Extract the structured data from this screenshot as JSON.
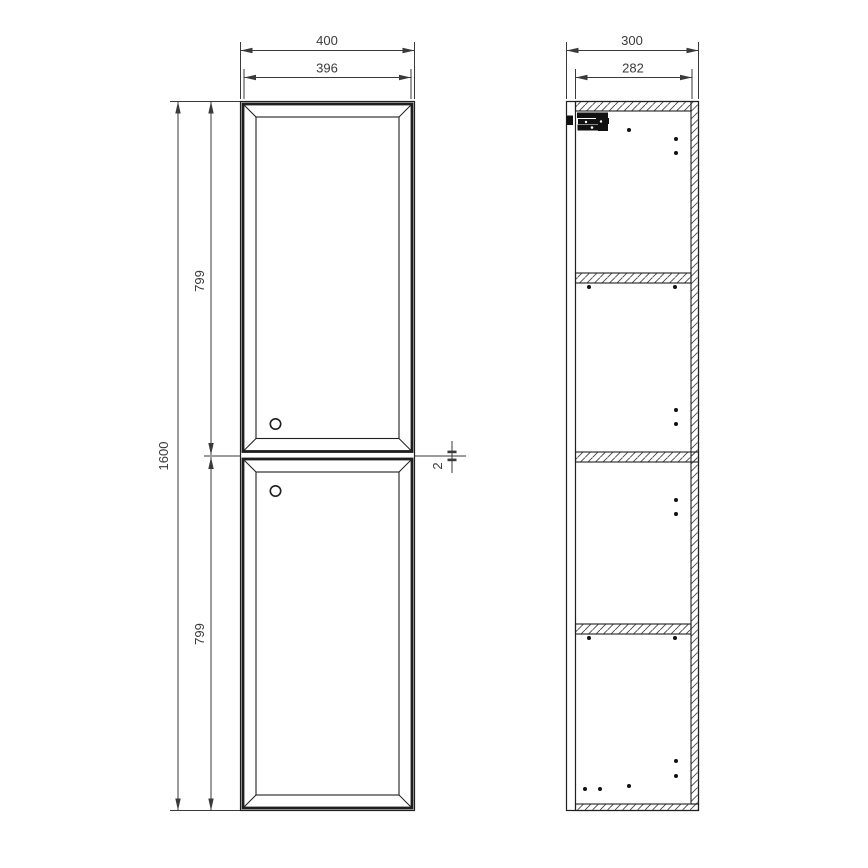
{
  "colors": {
    "background": "#ffffff",
    "object_line": "#1f1f1f",
    "dimension_line": "#3a3a3a",
    "hatch_line": "#444444",
    "hinge_fill": "#111111"
  },
  "front_view": {
    "dims": {
      "width_outer": "400",
      "width_inner": "396",
      "height_total": "1600",
      "upper_door_height": "799",
      "lower_door_height": "799",
      "door_gap": "2"
    },
    "knobs": [
      [
        275.5,
        424
      ],
      [
        275.5,
        491
      ]
    ]
  },
  "side_view": {
    "dims": {
      "depth_outer": "300",
      "depth_inner": "282"
    },
    "drill_holes": [
      [
        629,
        130
      ],
      [
        676,
        139
      ],
      [
        676,
        153
      ],
      [
        589,
        287
      ],
      [
        675,
        287
      ],
      [
        676,
        410
      ],
      [
        676,
        424
      ],
      [
        676,
        500
      ],
      [
        676,
        514
      ],
      [
        589,
        638
      ],
      [
        675,
        638
      ],
      [
        676,
        761
      ],
      [
        676,
        776
      ],
      [
        629,
        786
      ],
      [
        585,
        789
      ],
      [
        600,
        789
      ]
    ]
  }
}
